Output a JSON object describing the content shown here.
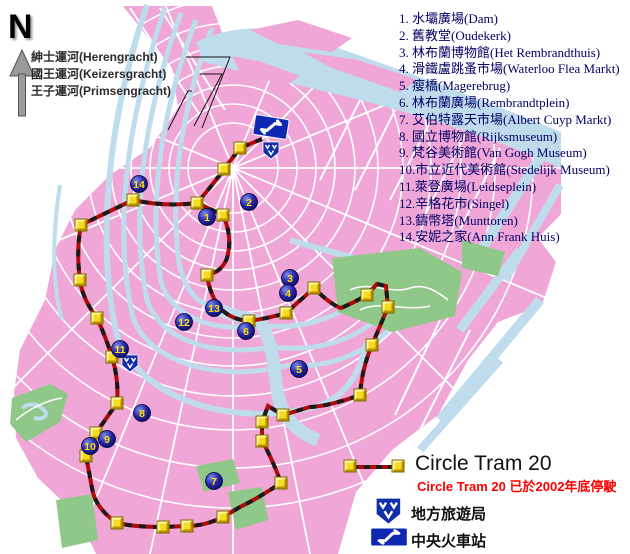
{
  "compass": {
    "label": "N"
  },
  "canal_labels": [
    "紳士運河(Herengracht)",
    "國王運河(Keizersgracht)",
    "王子運河(Primsengracht)"
  ],
  "attractions": [
    "1. 水壩廣場(Dam)",
    "2. 舊教堂(Oudekerk)",
    "3. 林布蘭博物館(Het Rembrandthuis)",
    "4. 滑鐵盧跳蚤市場(Waterloo Flea Markt)",
    "5. 瘦橋(Magerebrug)",
    "6. 林布蘭廣場(Rembrandtplein)",
    "7. 艾伯特露天市場(Albert Cuyp Markt)",
    "8. 國立博物館(Rijksmuseum)",
    "9. 梵谷美術館(Van Gogh Museum)",
    "10.市立近代美術館(Stedelijk Museum)",
    "11.萊登廣場(Leidseplein)",
    "12.辛格花市(Singel)",
    "13.鑄幣塔(Munttoren)",
    "14.安妮之家(Ann Frank Huis)"
  ],
  "legend": {
    "tram_label": "Circle Tram 20",
    "tram_note": "Circle Tram 20  已於2002年底停駛",
    "vvv_label": "地方旅遊局",
    "station_label": "中央火車站"
  },
  "map": {
    "colors": {
      "block_pink": "#F0A6D6",
      "water_blue": "#BFDCEC",
      "park_green": "#8FC888",
      "route_red": "#AD0A0A",
      "route_dash_black": "#1A1A1A",
      "stop_yellow": "#F6DC1E",
      "marker_navy": "#15158E",
      "marker_number_yellow": "#FFE000",
      "icon_blue": "#0F28B4"
    },
    "attraction_markers": [
      {
        "n": "1",
        "x": 207,
        "y": 217
      },
      {
        "n": "2",
        "x": 249,
        "y": 202
      },
      {
        "n": "3",
        "x": 290,
        "y": 278
      },
      {
        "n": "4",
        "x": 288,
        "y": 293
      },
      {
        "n": "5",
        "x": 299,
        "y": 369
      },
      {
        "n": "6",
        "x": 246,
        "y": 331
      },
      {
        "n": "7",
        "x": 214,
        "y": 481
      },
      {
        "n": "8",
        "x": 142,
        "y": 413
      },
      {
        "n": "9",
        "x": 107,
        "y": 439
      },
      {
        "n": "10",
        "x": 90,
        "y": 446
      },
      {
        "n": "11",
        "x": 120,
        "y": 349
      },
      {
        "n": "12",
        "x": 184,
        "y": 322
      },
      {
        "n": "13",
        "x": 214,
        "y": 308
      },
      {
        "n": "14",
        "x": 139,
        "y": 184
      }
    ],
    "tram_stops": [
      [
        240,
        148
      ],
      [
        224,
        169
      ],
      [
        197,
        203
      ],
      [
        223,
        215
      ],
      [
        207,
        275
      ],
      [
        249,
        321
      ],
      [
        286,
        313
      ],
      [
        314,
        288
      ],
      [
        367,
        295
      ],
      [
        388,
        307
      ],
      [
        372,
        345
      ],
      [
        360,
        395
      ],
      [
        283,
        415
      ],
      [
        262,
        422
      ],
      [
        262,
        441
      ],
      [
        281,
        483
      ],
      [
        223,
        517
      ],
      [
        187,
        526
      ],
      [
        163,
        527
      ],
      [
        117,
        523
      ],
      [
        86,
        456
      ],
      [
        96,
        433
      ],
      [
        117,
        403
      ],
      [
        112,
        357
      ],
      [
        97,
        318
      ],
      [
        80,
        280
      ],
      [
        81,
        225
      ],
      [
        133,
        200
      ]
    ],
    "vvv_icons": [
      [
        271,
        150
      ],
      [
        130,
        363
      ]
    ],
    "ns_icon": [
      271,
      127
    ]
  }
}
